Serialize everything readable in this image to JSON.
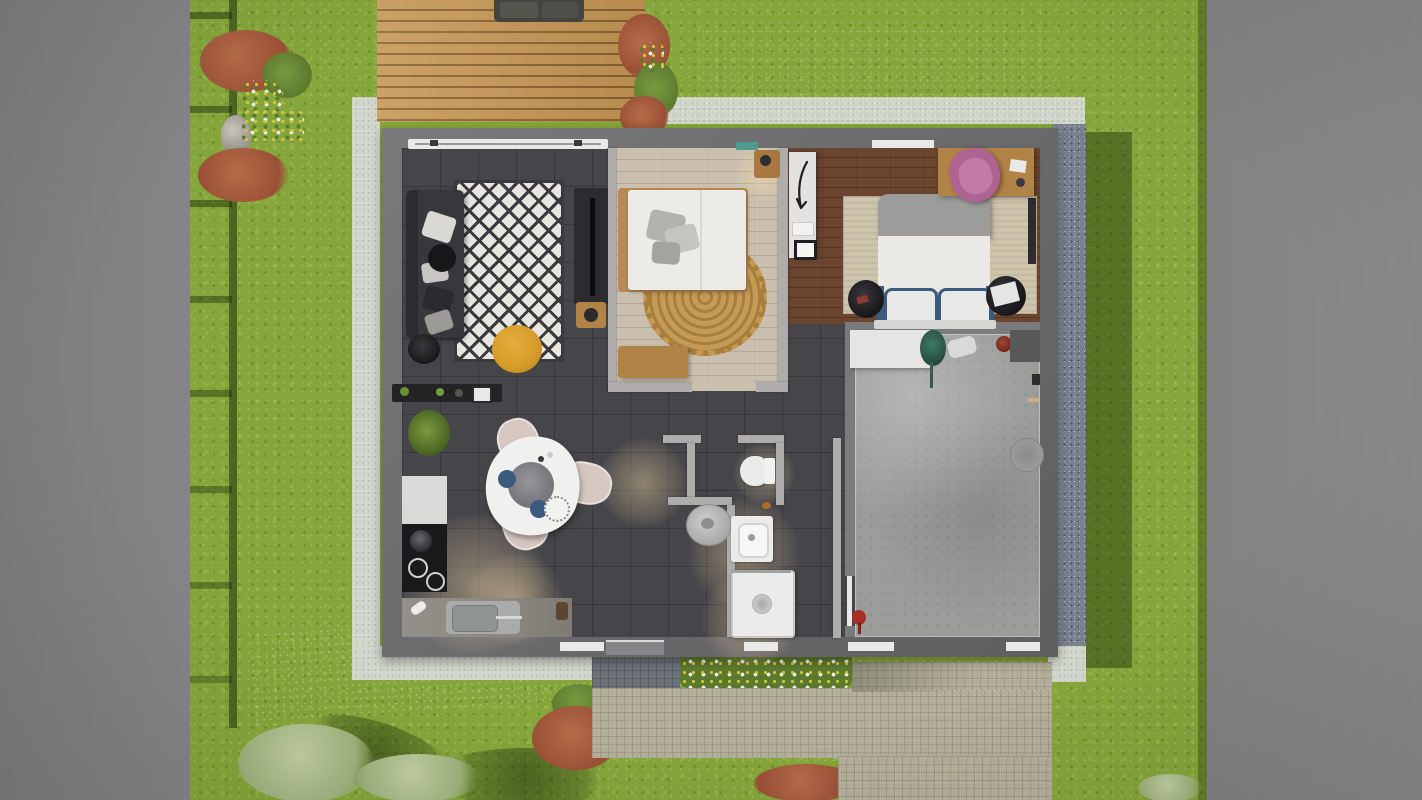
{
  "scene": {
    "type": "3d-architectural-floorplan-top-view",
    "description": "Top-down 3D render of a single-storey house with garden, wooden terrace, gravel border, paved driveway and fenced lawn",
    "width_px": 1422,
    "height_px": 800
  },
  "rooms": [
    {
      "name": "terrace-deck",
      "items": [
        "outdoor-sofa",
        "shrub-border"
      ]
    },
    {
      "name": "living-room",
      "items": [
        "sofa",
        "cushions",
        "black-white-diamond-rug",
        "yellow-pouf",
        "round-side-table",
        "tv-console",
        "wood-side-table",
        "sideboard"
      ]
    },
    {
      "name": "kitchen-dining",
      "items": [
        "plant",
        "white-counter",
        "black-cooktop",
        "sink-counter",
        "triangular-dining-table",
        "three-chairs",
        "serving-platter",
        "navy-plates"
      ]
    },
    {
      "name": "bedroom-1",
      "items": [
        "double-bed-white",
        "gray-pillows",
        "round-jute-rug",
        "wood-bench",
        "nightstand",
        "teal-wall-art"
      ]
    },
    {
      "name": "bedroom-2",
      "items": [
        "double-bed-navy-trim",
        "beige-rug",
        "two-round-nightstands",
        "desk",
        "pink-chair",
        "white-wardrobe"
      ]
    },
    {
      "name": "bathroom",
      "items": [
        "toilet",
        "round-washer",
        "vanity-sink",
        "shower-tray"
      ]
    },
    {
      "name": "garage",
      "items": [
        "white-shelf",
        "green-plant",
        "red-canister",
        "dark-mat",
        "floor-drain",
        "fire-extinguisher"
      ]
    },
    {
      "name": "garden",
      "items": [
        "fence-shadow",
        "red-shrubs",
        "flower-clusters",
        "stone",
        "pale-bushes",
        "flower-bed",
        "paved-path",
        "driveway"
      ]
    }
  ],
  "palette": {
    "road_left": "#7e7e80",
    "road_right": "#8b8b8d",
    "grass": "#85a63a",
    "walkway": "#cfd4c8",
    "gravel": "#78818d",
    "pavement": "#b3ae98",
    "pavement_dark": "#6d727a",
    "deck": "#c79755",
    "deck_gap": "#8a6331",
    "wall": "#6d6d6f",
    "wall_dark": "#5f5f61",
    "wall_inner": "#aeadab",
    "floor_dark": "#46464a",
    "wood_light": "#cbc0af",
    "wood_light_line": "#b5a995",
    "wood_dark": "#6b4530",
    "wood_dark_line": "#55371f",
    "concrete": "#9c9c9a",
    "rug_white": "#e7e5df",
    "rug_pattern": "#3a3a3e",
    "sofa": "#38383c",
    "pouf": "#d49b28",
    "jute": "#c49a55",
    "jute_dark": "#a87e3d",
    "bed_white": "#ecebe8",
    "pillow_gray": "#b4b2af",
    "blanket_gray": "#9c9c9a",
    "navy": "#3c5a80",
    "rug_beige": "#cec4ac",
    "pink": "#ae6391",
    "pink_light": "#c27aa8",
    "desk_wood": "#b28347",
    "counter_black": "#1a1a1d",
    "steel": "#a9abaa",
    "marble": "#8b8781",
    "chair_blush": "#d7c7c1",
    "table_white": "#f0f0ee",
    "white_goods": "#ebebe9",
    "bush_red": "#9a4f35",
    "bush_red_l": "#b56d48",
    "bush_green": "#5c7a2e",
    "bush_green_l": "#7a9a40",
    "bush_pale": "#9eb27c",
    "bush_pale_l": "#c2cfa4",
    "flower_yellow": "#d8c23a",
    "flower_white": "#eef0e8",
    "teal": "#4e9a8e",
    "red_item": "#a92f26"
  }
}
